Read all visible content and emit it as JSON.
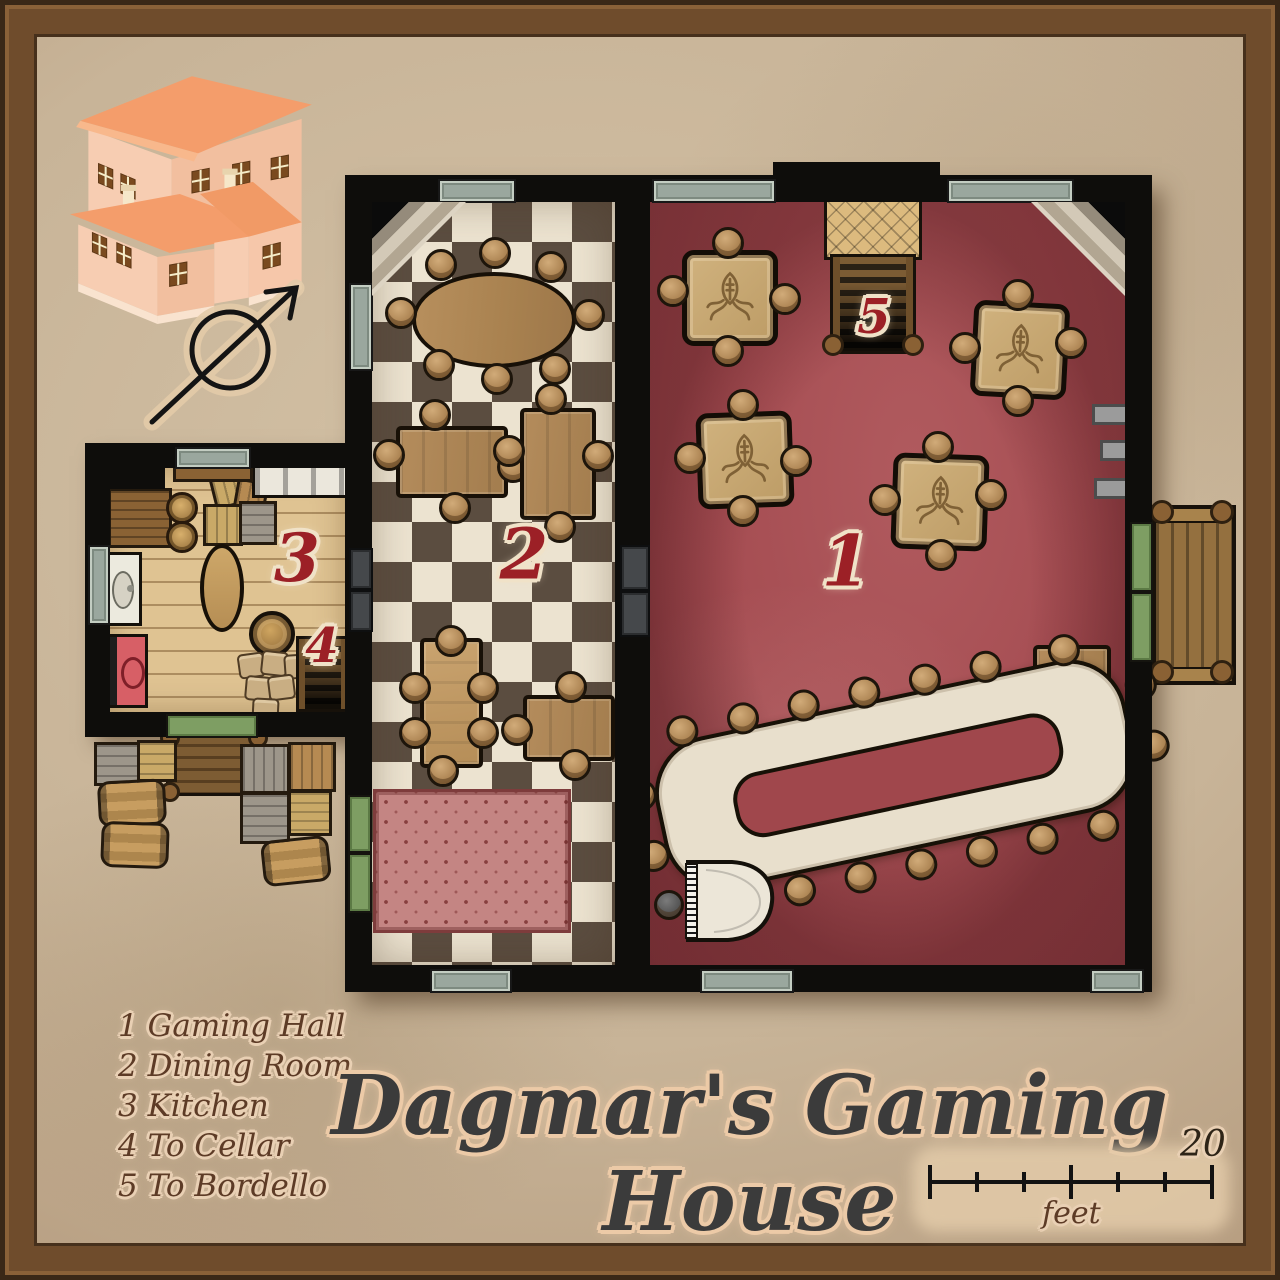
{
  "map": {
    "title": "Dagmar's Gaming House",
    "legend": {
      "items": [
        {
          "number": "1",
          "label": "Gaming Hall"
        },
        {
          "number": "2",
          "label": "Dining Room"
        },
        {
          "number": "3",
          "label": "Kitchen"
        },
        {
          "number": "4",
          "label": "To Cellar"
        },
        {
          "number": "5",
          "label": "To Bordello"
        }
      ]
    },
    "markers": {
      "gaming_hall": "1",
      "dining_room": "2",
      "kitchen": "3",
      "cellar_stairs": "4",
      "bordello_stairs": "5"
    },
    "scale_bar": {
      "value": "20",
      "unit": "feet"
    },
    "compass": "northeast-arrow-icon",
    "colors": {
      "frame": "#6f4c2c",
      "parchment": "#c8b498",
      "gaming_hall_carpet": "#a64e53",
      "dining_tile_dark": "#5b4d40",
      "dining_tile_light": "#ece3d0",
      "kitchen_floor": "#dfc392",
      "wall": "#0e0d0b",
      "room_numeral": "#9c2026",
      "house_walls": "#f6c9ae",
      "house_roof": "#f5a06e",
      "rug": "#c48583",
      "long_table": "#e8dfcc"
    }
  }
}
